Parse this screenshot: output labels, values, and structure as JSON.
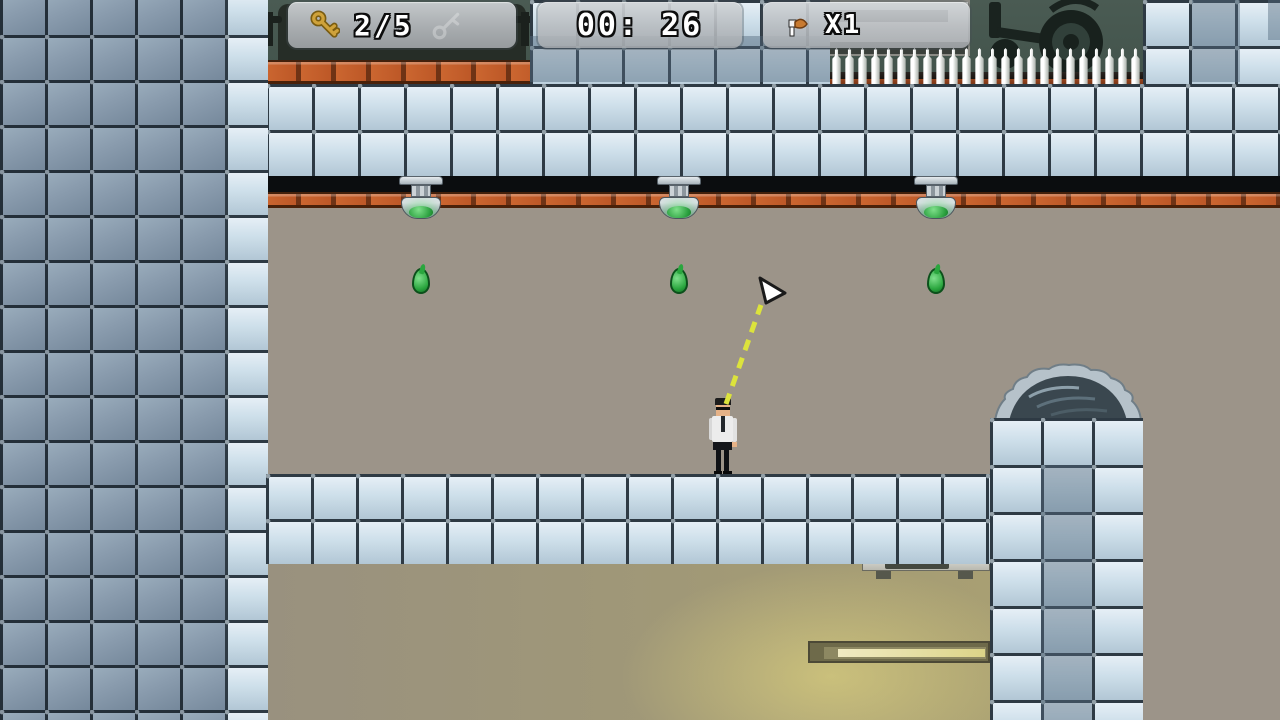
{
  "hud": {
    "keys": {
      "icon": "key-icon",
      "count": "2/5",
      "ghost_icon": "key-outline-icon"
    },
    "timer": {
      "value": "00: 26"
    },
    "items": {
      "icon": "item-icon",
      "count": "X1"
    }
  },
  "colors": {
    "key_gold": "#c79a33",
    "aim_line": "#dce33c",
    "drip_green": "#2aa63e",
    "brick": "#bd5827",
    "teal_background": "#46564e"
  },
  "level": {
    "lamps": [
      {
        "x": 421
      },
      {
        "x": 679
      },
      {
        "x": 936
      }
    ],
    "drips": [
      {
        "x": 421,
        "y": 268
      },
      {
        "x": 679,
        "y": 268
      },
      {
        "x": 936,
        "y": 268
      }
    ],
    "spike_count": 24,
    "player": {
      "x": 708,
      "y": 398
    },
    "cursor": {
      "x": 757,
      "y": 276
    },
    "aim_line": {
      "x1": 726,
      "y1": 404,
      "x2": 761,
      "y2": 305
    }
  }
}
